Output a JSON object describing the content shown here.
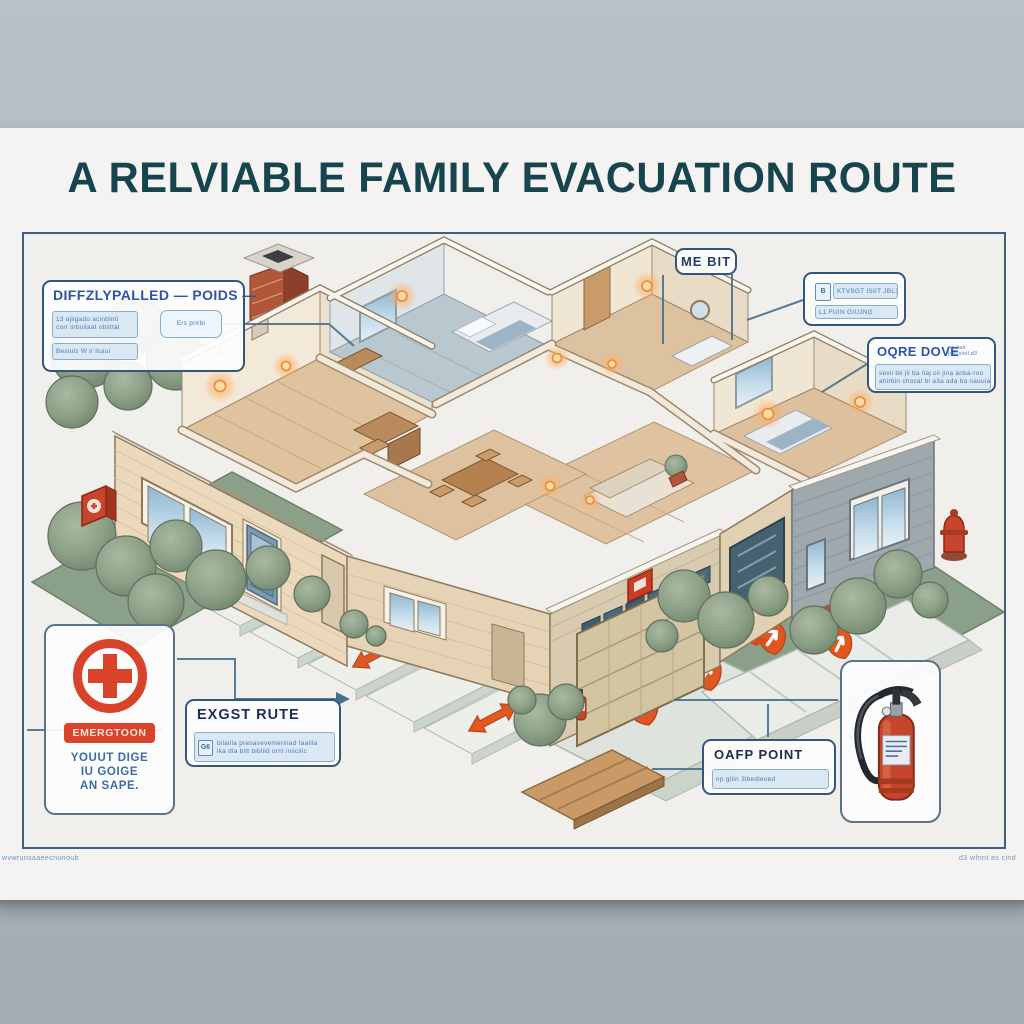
{
  "poster": {
    "title": "A  RELVIABLE FAMILY EVACUATION ROUTE",
    "footer_left": "wvwrunsaaeecnunoub",
    "footer_right": "d3 wfnnt as cind"
  },
  "callouts": {
    "prep_panel": {
      "title": "DIFFZLYPALLED — POIDS —",
      "note_a_line1": "13 ajiigado acinbinti",
      "note_a_line2": "corr inbuilaat obiittal",
      "note_b": "Besiulz W ir ituiui",
      "tag": "Ers prirbi"
    },
    "roof_label": {
      "text": "ME BIT"
    },
    "alarm_panel": {
      "icon": "B",
      "row1": "KTVSGT ISIIT JBL3",
      "row2": "L1 FUIN GIUJNG"
    },
    "route_note": {
      "title": "OQRE DOVE",
      "sup_line1": "no itan",
      "sup_line2": "jaecsinil d3",
      "body_line1": "sevii bii jii ba itaj cii jina anba-roo",
      "body_line2": "ahirbin chocal bi a3a ada ba nauuiata"
    },
    "emergency_sign": {
      "badge": "EMERGTOON",
      "line1": "YOUUT DIGE",
      "line2": "IU GOIGE",
      "line3": "AN SAPE."
    },
    "exit_route": {
      "title": "EXGST RUTE",
      "icon": "G6",
      "note_line1": "bilailla presavevemerinad taalila",
      "note_line2": "ika dla bitt bibliid orni iniicilic"
    },
    "gather_point": {
      "title": "OAFP POINT",
      "note": "np gtiin 3ibedieoed"
    }
  },
  "colors": {
    "title_teal": "#16454f",
    "callout_blue": "#33567c",
    "accent_orange": "#e2571f",
    "emergency_red": "#d8432a",
    "paper": "#f5f3f2",
    "wall_background": "#b3bac1",
    "grass_green": "#8ba088",
    "house_cream": "#ecd9bc",
    "house_gray": "#9fa8ad"
  }
}
